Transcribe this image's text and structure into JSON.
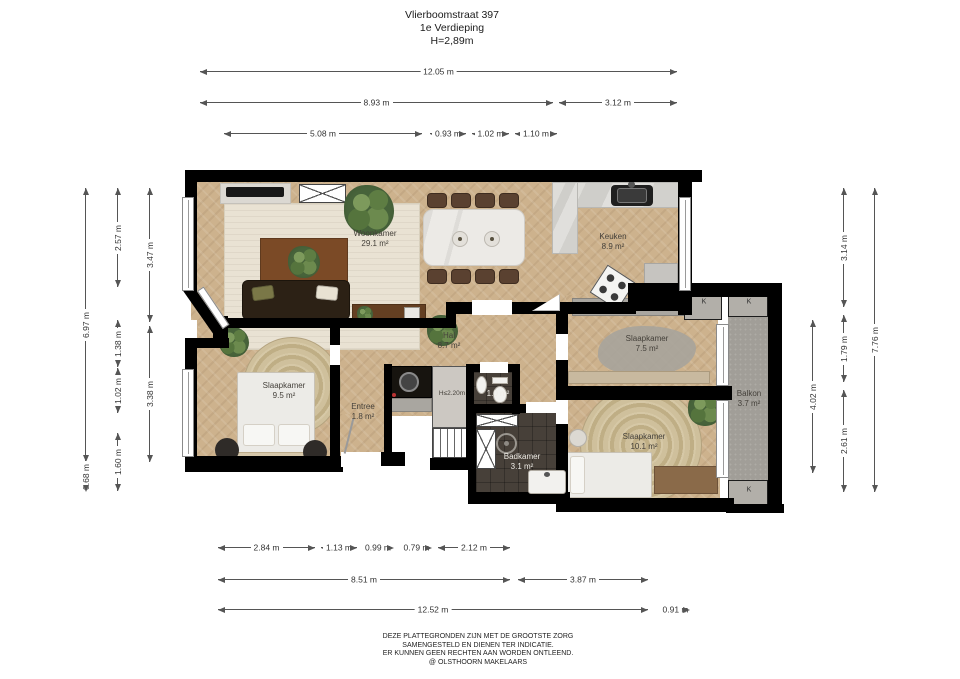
{
  "title": {
    "address": "Vlierboomstraat 397",
    "floor": "1e Verdieping",
    "height": "H=2,89m"
  },
  "disclaimer": [
    "DEZE PLATTEGRONDEN ZIJN MET DE GROOTSTE ZORG",
    "SAMENGESTELD EN DIENEN TER INDICATIE.",
    "ER KUNNEN GEEN RECHTEN AAN WORDEN ONTLEEND.",
    "@ OLSTHOORN MAKELAARS"
  ],
  "room_labels": [
    {
      "lines": [
        "Woonkamer",
        "29.1 m²"
      ],
      "x": 375,
      "y": 229
    },
    {
      "lines": [
        "Keuken",
        "8.9 m²"
      ],
      "x": 613,
      "y": 232
    },
    {
      "lines": [
        "Hal",
        "8.7 m²"
      ],
      "x": 449,
      "y": 331
    },
    {
      "lines": [
        "Slaapkamer",
        "9.5 m²"
      ],
      "x": 284,
      "y": 381
    },
    {
      "lines": [
        "Entree",
        "1.8 m²"
      ],
      "x": 363,
      "y": 402
    },
    {
      "lines": [
        "H≤2.20m"
      ],
      "x": 452,
      "y": 389,
      "small": true
    },
    {
      "lines": [
        "1.0 m²"
      ],
      "x": 498,
      "y": 389,
      "light": true
    },
    {
      "lines": [
        "Badkamer",
        "3.1 m²"
      ],
      "x": 522,
      "y": 452,
      "light": true
    },
    {
      "lines": [
        "Slaapkamer",
        "7.5 m²"
      ],
      "x": 647,
      "y": 334
    },
    {
      "lines": [
        "Slaapkamer",
        "10.1 m²"
      ],
      "x": 644,
      "y": 432
    },
    {
      "lines": [
        "Balkon",
        "3.7 m²"
      ],
      "x": 749,
      "y": 389
    }
  ],
  "closet_labels": [
    {
      "text": "K",
      "x": 704,
      "y": 302
    },
    {
      "text": "K",
      "x": 749,
      "y": 302
    },
    {
      "text": "K",
      "x": 749,
      "y": 490
    }
  ],
  "dimensions": {
    "horizontal": [
      {
        "t": "12.05 m",
        "x1": 200,
        "x2": 677,
        "y": 71
      },
      {
        "t": "8.93 m",
        "x1": 200,
        "x2": 553,
        "y": 102
      },
      {
        "t": "3.12 m",
        "x1": 559,
        "x2": 677,
        "y": 102
      },
      {
        "t": "5.08 m",
        "x1": 224,
        "x2": 422,
        "y": 133
      },
      {
        "t": "0.93 m",
        "x1": 430,
        "x2": 466,
        "y": 133
      },
      {
        "t": "1.02 m",
        "x1": 472,
        "x2": 509,
        "y": 133
      },
      {
        "t": "1.10 m",
        "x1": 515,
        "x2": 557,
        "y": 133
      },
      {
        "t": "2.84 m",
        "x1": 218,
        "x2": 315,
        "y": 547
      },
      {
        "t": "1.13 m",
        "x1": 321,
        "x2": 357,
        "y": 547
      },
      {
        "t": "0.99 m",
        "x1": 362,
        "x2": 394,
        "y": 547
      },
      {
        "t": "0.79 m",
        "x1": 401,
        "x2": 432,
        "y": 547
      },
      {
        "t": "2.12 m",
        "x1": 438,
        "x2": 510,
        "y": 547
      },
      {
        "t": "8.51 m",
        "x1": 218,
        "x2": 510,
        "y": 579
      },
      {
        "t": "3.87 m",
        "x1": 518,
        "x2": 648,
        "y": 579
      },
      {
        "t": "12.52 m",
        "x1": 218,
        "x2": 648,
        "y": 609
      },
      {
        "t": "0.91 m",
        "x1": 661,
        "x2": 690,
        "y": 609
      }
    ],
    "vertical": [
      {
        "t": "6.97 m",
        "x": 85,
        "y1": 188,
        "y2": 462
      },
      {
        "t": "0.68 m",
        "x": 85,
        "y1": 462,
        "y2": 492
      },
      {
        "t": "2.57 m",
        "x": 117,
        "y1": 188,
        "y2": 287
      },
      {
        "t": "1.38 m",
        "x": 117,
        "y1": 320,
        "y2": 367
      },
      {
        "t": "1.02 m",
        "x": 117,
        "y1": 368,
        "y2": 413
      },
      {
        "t": "1.60 m",
        "x": 117,
        "y1": 433,
        "y2": 491
      },
      {
        "t": "3.47 m",
        "x": 149,
        "y1": 188,
        "y2": 322
      },
      {
        "t": "3.38 m",
        "x": 149,
        "y1": 326,
        "y2": 462
      },
      {
        "t": "4.02 m",
        "x": 812,
        "y1": 320,
        "y2": 473
      },
      {
        "t": "3.14 m",
        "x": 843,
        "y1": 188,
        "y2": 307
      },
      {
        "t": "1.79 m",
        "x": 843,
        "y1": 315,
        "y2": 382
      },
      {
        "t": "2.61 m",
        "x": 843,
        "y1": 390,
        "y2": 492
      },
      {
        "t": "7.76 m",
        "x": 874,
        "y1": 188,
        "y2": 492
      }
    ]
  },
  "colors": {
    "wall": "#000000",
    "floor": "#cdb28d",
    "dark_tile": "#474039",
    "balcony": "#a19e98",
    "living_rug": "#e9e2d3",
    "wood": "#7b4a26",
    "label_text": "#44403a"
  }
}
